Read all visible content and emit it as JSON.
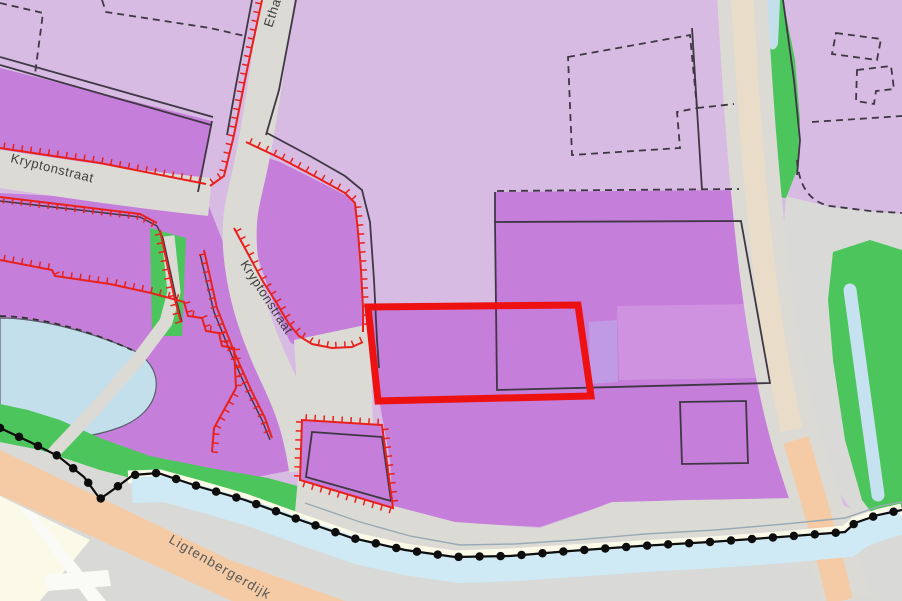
{
  "map": {
    "streets": {
      "kryptonstraat_west": "Kryptonstraat",
      "kryptonstraat_south": "Kryptonstraat",
      "ethaanstraat": "Ethaanstraat",
      "ligtenbergerdijk": "Ligtenbergerdijk"
    },
    "highlight": {
      "type": "selected-parcel-outline"
    },
    "colors": {
      "zone_light": "#d7bbe3",
      "zone_medium": "#c57ed9",
      "zone_patch_light": "#cf92e0",
      "zone_patch_blue": "#c09ae4",
      "road": "#dcdad5",
      "road_center": "#e9ddc9",
      "dike_road": "#f5cba5",
      "water_pond": "#c3dfec",
      "water_canal": "#cfeaf5",
      "water_ditch": "#c6e1f0",
      "green": "#4cc55c",
      "cream": "#fbfae8",
      "field_gray": "#d9d9d7",
      "white_road": "#fafaf7",
      "line_dark": "#3f3744",
      "boundary_red": "#e8211d",
      "highlight_red": "#ee1111",
      "dot_black": "#0d0d0d",
      "label": "#3e3e3e"
    }
  }
}
